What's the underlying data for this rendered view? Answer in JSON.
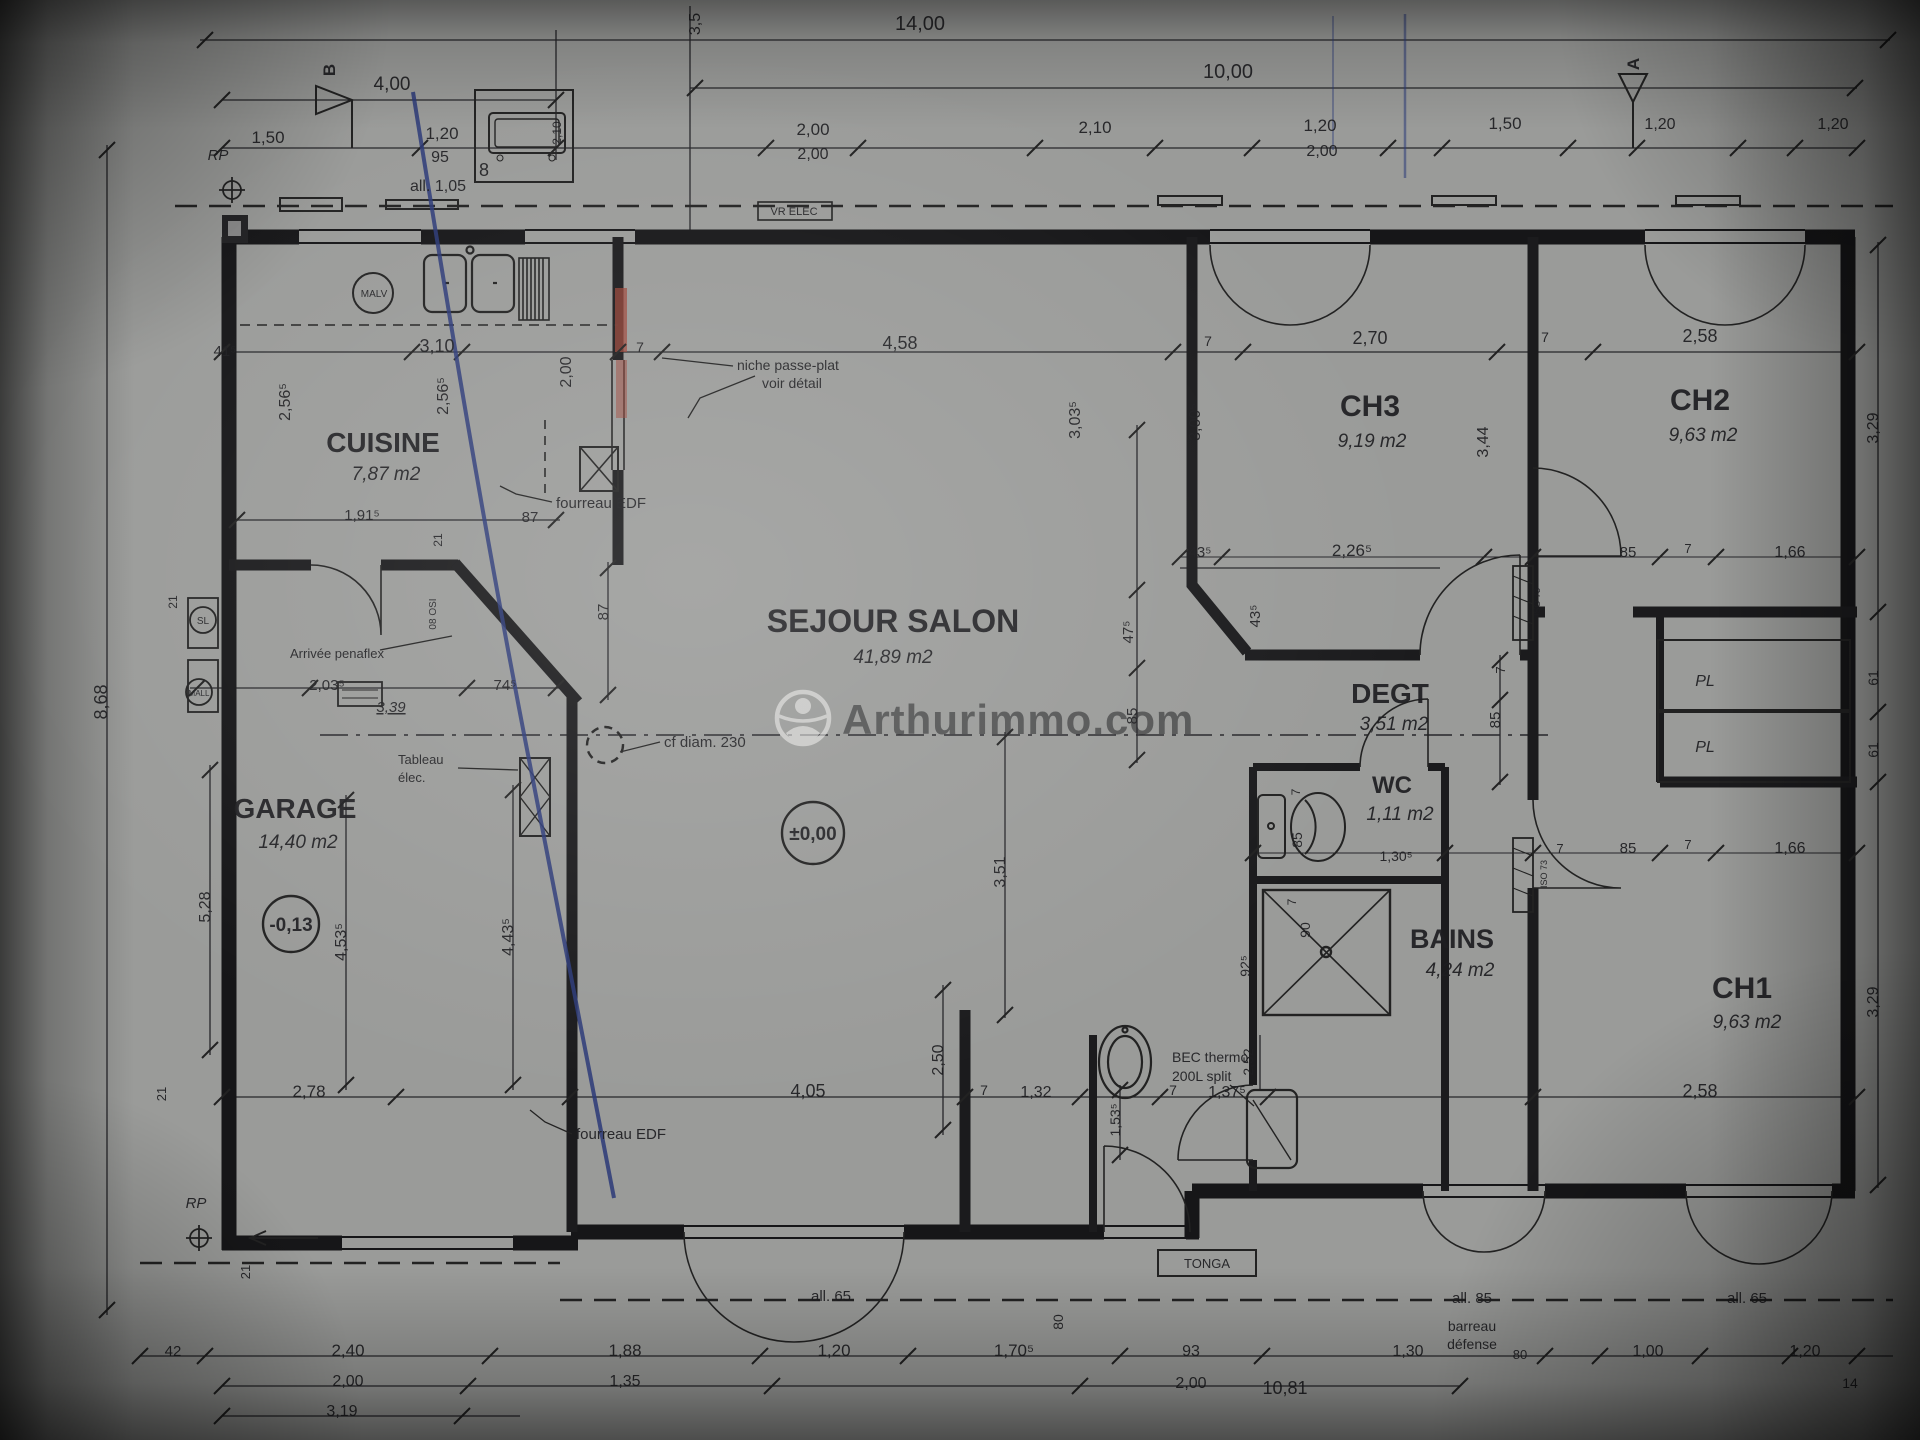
{
  "watermark": {
    "text": "Arthurimmo.com"
  },
  "rooms": [
    {
      "name": "CUISINE",
      "area": "7,87 m2",
      "nx": 383,
      "ny": 452,
      "ns": 28,
      "ax": 386,
      "ay": 480
    },
    {
      "name": "GARAGE",
      "area": "14,40 m2",
      "nx": 295,
      "ny": 818,
      "ns": 28,
      "ax": 298,
      "ay": 848
    },
    {
      "name": "SEJOUR SALON",
      "area": "41,89 m2",
      "nx": 893,
      "ny": 632,
      "ns": 32,
      "ax": 893,
      "ay": 663
    },
    {
      "name": "CH3",
      "area": "9,19 m2",
      "nx": 1370,
      "ny": 416,
      "ns": 30,
      "ax": 1372,
      "ay": 447
    },
    {
      "name": "CH2",
      "area": "9,63 m2",
      "nx": 1700,
      "ny": 410,
      "ns": 30,
      "ax": 1703,
      "ay": 441
    },
    {
      "name": "DEGT",
      "area": "3,51 m2",
      "nx": 1390,
      "ny": 703,
      "ns": 28,
      "ax": 1394,
      "ay": 730
    },
    {
      "name": "WC",
      "area": "1,11 m2",
      "nx": 1392,
      "ny": 793,
      "ns": 24,
      "ax": 1400,
      "ay": 820
    },
    {
      "name": "BAINS",
      "area": "4,24 m2",
      "nx": 1452,
      "ny": 948,
      "ns": 27,
      "ax": 1460,
      "ay": 976
    },
    {
      "name": "CH1",
      "area": "9,63 m2",
      "nx": 1742,
      "ny": 998,
      "ns": 30,
      "ax": 1747,
      "ay": 1028
    }
  ],
  "levels": [
    {
      "t": "±0,00",
      "x": 813,
      "y": 840
    },
    {
      "t": "-0,13",
      "x": 291,
      "y": 931
    }
  ],
  "labels": [
    {
      "t": "14,00",
      "x": 920,
      "y": 30,
      "s": 20
    },
    {
      "t": "3,5",
      "x": 700,
      "y": 24,
      "s": 16,
      "r": -90
    },
    {
      "t": "10,00",
      "x": 1228,
      "y": 78,
      "s": 20
    },
    {
      "t": "4,00",
      "x": 392,
      "y": 90,
      "s": 19
    },
    {
      "t": "B",
      "x": 335,
      "y": 70,
      "s": 17,
      "w": 700,
      "r": -90
    },
    {
      "t": "A",
      "x": 1639,
      "y": 64,
      "s": 17,
      "w": 700,
      "r": -90
    },
    {
      "t": "1,50",
      "x": 268,
      "y": 143,
      "s": 17
    },
    {
      "t": "1,20",
      "x": 442,
      "y": 139,
      "s": 17
    },
    {
      "t": "95",
      "x": 440,
      "y": 162,
      "s": 16
    },
    {
      "t": "all. 1,05",
      "x": 438,
      "y": 191,
      "s": 16
    },
    {
      "t": "RP",
      "x": 218,
      "y": 160,
      "s": 15,
      "i": 1
    },
    {
      "t": "2,00",
      "x": 813,
      "y": 135,
      "s": 17
    },
    {
      "t": "2,00",
      "x": 813,
      "y": 159,
      "s": 16
    },
    {
      "t": "2,10",
      "x": 1095,
      "y": 133,
      "s": 17
    },
    {
      "t": "1,20",
      "x": 1320,
      "y": 131,
      "s": 17
    },
    {
      "t": "2,00",
      "x": 1322,
      "y": 156,
      "s": 16
    },
    {
      "t": "1,50",
      "x": 1505,
      "y": 129,
      "s": 17
    },
    {
      "t": "1,20",
      "x": 1660,
      "y": 129,
      "s": 16
    },
    {
      "t": "1,20",
      "x": 1833,
      "y": 129,
      "s": 16
    },
    {
      "t": "VR ELEC",
      "x": 794,
      "y": 215,
      "s": 11
    },
    {
      "t": "8",
      "x": 484,
      "y": 176,
      "s": 18
    },
    {
      "t": "2,10",
      "x": 561,
      "y": 133,
      "s": 12,
      "r": -90
    },
    {
      "t": "41⁵",
      "x": 225,
      "y": 356,
      "s": 15
    },
    {
      "t": "3,10",
      "x": 437,
      "y": 352,
      "s": 18
    },
    {
      "t": "2,00",
      "x": 571,
      "y": 372,
      "s": 16,
      "r": -90
    },
    {
      "t": "7",
      "x": 640,
      "y": 352,
      "s": 14
    },
    {
      "t": "4,58",
      "x": 900,
      "y": 349,
      "s": 18
    },
    {
      "t": "7",
      "x": 1208,
      "y": 346,
      "s": 14
    },
    {
      "t": "2,70",
      "x": 1370,
      "y": 344,
      "s": 18
    },
    {
      "t": "7",
      "x": 1545,
      "y": 342,
      "s": 14
    },
    {
      "t": "2,58",
      "x": 1700,
      "y": 342,
      "s": 18
    },
    {
      "t": "2,56⁵",
      "x": 290,
      "y": 402,
      "s": 16,
      "r": -90
    },
    {
      "t": "2,56⁵",
      "x": 448,
      "y": 396,
      "s": 16,
      "r": -90
    },
    {
      "t": "3,03⁵",
      "x": 1080,
      "y": 420,
      "s": 16,
      "r": -90
    },
    {
      "t": "3,00⁵",
      "x": 1200,
      "y": 422,
      "s": 16,
      "r": -90
    },
    {
      "t": "3,44",
      "x": 1488,
      "y": 442,
      "s": 16,
      "r": -90
    },
    {
      "t": "3,29",
      "x": 1878,
      "y": 428,
      "s": 16,
      "r": -90
    },
    {
      "t": "MALV",
      "x": 374,
      "y": 297,
      "s": 10
    },
    {
      "t": "niche passe-plat",
      "x": 737,
      "y": 370,
      "s": 14,
      "a": "start"
    },
    {
      "t": "voir détail",
      "x": 762,
      "y": 388,
      "s": 14,
      "a": "start"
    },
    {
      "t": "fourreau EDF",
      "x": 556,
      "y": 508,
      "s": 15,
      "a": "start"
    },
    {
      "t": "1,91⁵",
      "x": 362,
      "y": 520,
      "s": 15
    },
    {
      "t": "87",
      "x": 530,
      "y": 522,
      "s": 15
    },
    {
      "t": "21",
      "x": 442,
      "y": 540,
      "s": 12,
      "r": -90
    },
    {
      "t": "SL",
      "x": 203,
      "y": 624,
      "s": 10
    },
    {
      "t": "MALL",
      "x": 199,
      "y": 696,
      "s": 8
    },
    {
      "t": "21",
      "x": 177,
      "y": 602,
      "s": 12,
      "r": -90
    },
    {
      "t": "08 OSI",
      "x": 436,
      "y": 614,
      "s": 10,
      "r": -90
    },
    {
      "t": "74⁵",
      "x": 505,
      "y": 690,
      "s": 15
    },
    {
      "t": "2,03⁵",
      "x": 327,
      "y": 690,
      "s": 15
    },
    {
      "t": "3,39",
      "x": 391,
      "y": 712,
      "s": 15,
      "i": 1,
      "u": 1
    },
    {
      "t": "Arrivée penaflex",
      "x": 290,
      "y": 658,
      "s": 13,
      "a": "start"
    },
    {
      "t": "87",
      "x": 608,
      "y": 612,
      "s": 15,
      "r": -90
    },
    {
      "t": "Tableau",
      "x": 398,
      "y": 764,
      "s": 13,
      "a": "start"
    },
    {
      "t": "élec.",
      "x": 398,
      "y": 782,
      "s": 13,
      "a": "start"
    },
    {
      "t": "cf diam. 230",
      "x": 664,
      "y": 747,
      "s": 15,
      "a": "start"
    },
    {
      "t": "47⁵",
      "x": 1133,
      "y": 632,
      "s": 15,
      "r": -90
    },
    {
      "t": "85",
      "x": 1137,
      "y": 716,
      "s": 15,
      "r": -90
    },
    {
      "t": "43⁵",
      "x": 1200,
      "y": 557,
      "s": 15
    },
    {
      "t": "2,26⁵",
      "x": 1352,
      "y": 556,
      "s": 17
    },
    {
      "t": "43⁵",
      "x": 1260,
      "y": 616,
      "s": 15,
      "r": -90
    },
    {
      "t": "85",
      "x": 1500,
      "y": 720,
      "s": 15,
      "r": -90
    },
    {
      "t": "7",
      "x": 1505,
      "y": 670,
      "s": 13,
      "r": -90
    },
    {
      "t": "85",
      "x": 1628,
      "y": 557,
      "s": 15
    },
    {
      "t": "7",
      "x": 1688,
      "y": 553,
      "s": 13
    },
    {
      "t": "1,66",
      "x": 1790,
      "y": 557,
      "s": 16
    },
    {
      "t": "ISO 73",
      "x": 1540,
      "y": 602,
      "s": 9,
      "r": -90
    },
    {
      "t": "ISO 73",
      "x": 1547,
      "y": 874,
      "s": 9,
      "r": -90
    },
    {
      "t": "PL",
      "x": 1705,
      "y": 686,
      "s": 16,
      "i": 1
    },
    {
      "t": "PL",
      "x": 1705,
      "y": 752,
      "s": 16,
      "i": 1
    },
    {
      "t": "61",
      "x": 1878,
      "y": 678,
      "s": 14,
      "r": -90
    },
    {
      "t": "61",
      "x": 1878,
      "y": 750,
      "s": 14,
      "r": -90
    },
    {
      "t": "7",
      "x": 1560,
      "y": 853,
      "s": 13
    },
    {
      "t": "85",
      "x": 1628,
      "y": 853,
      "s": 15
    },
    {
      "t": "7",
      "x": 1688,
      "y": 849,
      "s": 13
    },
    {
      "t": "1,66",
      "x": 1790,
      "y": 853,
      "s": 16
    },
    {
      "t": "1,30⁵",
      "x": 1396,
      "y": 861,
      "s": 14
    },
    {
      "t": "7",
      "x": 1300,
      "y": 792,
      "s": 12,
      "r": -90
    },
    {
      "t": "85",
      "x": 1302,
      "y": 840,
      "s": 14,
      "r": -90
    },
    {
      "t": "7",
      "x": 1296,
      "y": 902,
      "s": 12,
      "r": -90
    },
    {
      "t": "90",
      "x": 1310,
      "y": 930,
      "s": 14,
      "r": -90
    },
    {
      "t": "92⁵",
      "x": 1250,
      "y": 966,
      "s": 14,
      "r": -90
    },
    {
      "t": "8,68",
      "x": 107,
      "y": 702,
      "s": 18,
      "r": -90
    },
    {
      "t": "5,28",
      "x": 210,
      "y": 907,
      "s": 16,
      "r": -90
    },
    {
      "t": "4,53⁵",
      "x": 346,
      "y": 942,
      "s": 16,
      "r": -90
    },
    {
      "t": "4,43⁵",
      "x": 513,
      "y": 937,
      "s": 16,
      "r": -90
    },
    {
      "t": "3,51",
      "x": 1005,
      "y": 872,
      "s": 16,
      "r": -90
    },
    {
      "t": "2,50",
      "x": 943,
      "y": 1060,
      "s": 16,
      "r": -90
    },
    {
      "t": "fourreau EDF",
      "x": 576,
      "y": 1139,
      "s": 15,
      "a": "start"
    },
    {
      "t": "21",
      "x": 166,
      "y": 1094,
      "s": 13,
      "r": -90
    },
    {
      "t": "2,78",
      "x": 309,
      "y": 1097,
      "s": 17
    },
    {
      "t": "4,05",
      "x": 808,
      "y": 1097,
      "s": 18
    },
    {
      "t": "7",
      "x": 984,
      "y": 1095,
      "s": 14
    },
    {
      "t": "1,32",
      "x": 1036,
      "y": 1097,
      "s": 16
    },
    {
      "t": "1,53⁵",
      "x": 1120,
      "y": 1120,
      "s": 14,
      "r": -90
    },
    {
      "t": "7",
      "x": 1173,
      "y": 1095,
      "s": 14
    },
    {
      "t": "1,37⁵",
      "x": 1227,
      "y": 1097,
      "s": 16
    },
    {
      "t": "2,52",
      "x": 1253,
      "y": 1062,
      "s": 14,
      "r": -90
    },
    {
      "t": "BEC thermo",
      "x": 1172,
      "y": 1062,
      "s": 14,
      "a": "start"
    },
    {
      "t": "200L split",
      "x": 1172,
      "y": 1081,
      "s": 14,
      "a": "start"
    },
    {
      "t": "2,58",
      "x": 1700,
      "y": 1097,
      "s": 18
    },
    {
      "t": "3,29",
      "x": 1878,
      "y": 1002,
      "s": 16,
      "r": -90
    },
    {
      "t": "RP",
      "x": 196,
      "y": 1208,
      "s": 15,
      "i": 1
    },
    {
      "t": "21",
      "x": 250,
      "y": 1272,
      "s": 13,
      "r": -90
    },
    {
      "t": "TONGA",
      "x": 1207,
      "y": 1268,
      "s": 13
    },
    {
      "t": "all. 65",
      "x": 831,
      "y": 1301,
      "s": 15
    },
    {
      "t": "80",
      "x": 1063,
      "y": 1322,
      "s": 14,
      "r": -90
    },
    {
      "t": "all. 85",
      "x": 1472,
      "y": 1303,
      "s": 15
    },
    {
      "t": "barreau",
      "x": 1472,
      "y": 1331,
      "s": 14
    },
    {
      "t": "défense",
      "x": 1472,
      "y": 1349,
      "s": 14
    },
    {
      "t": "all. 65",
      "x": 1747,
      "y": 1303,
      "s": 15
    },
    {
      "t": "42",
      "x": 173,
      "y": 1356,
      "s": 15
    },
    {
      "t": "2,40",
      "x": 348,
      "y": 1356,
      "s": 17
    },
    {
      "t": "1,88",
      "x": 625,
      "y": 1356,
      "s": 17
    },
    {
      "t": "1,20",
      "x": 834,
      "y": 1356,
      "s": 17
    },
    {
      "t": "1,70⁵",
      "x": 1014,
      "y": 1356,
      "s": 17
    },
    {
      "t": "93",
      "x": 1191,
      "y": 1356,
      "s": 16
    },
    {
      "t": "1,30",
      "x": 1408,
      "y": 1356,
      "s": 16
    },
    {
      "t": "80",
      "x": 1520,
      "y": 1359,
      "s": 13
    },
    {
      "t": "1,00",
      "x": 1648,
      "y": 1356,
      "s": 16
    },
    {
      "t": "1,20",
      "x": 1805,
      "y": 1356,
      "s": 16
    },
    {
      "t": "2,00",
      "x": 348,
      "y": 1386,
      "s": 16
    },
    {
      "t": "1,35",
      "x": 625,
      "y": 1386,
      "s": 16
    },
    {
      "t": "2,00",
      "x": 1191,
      "y": 1388,
      "s": 16
    },
    {
      "t": "10,81",
      "x": 1285,
      "y": 1394,
      "s": 18
    },
    {
      "t": "3,19",
      "x": 342,
      "y": 1416,
      "s": 16
    },
    {
      "t": "14",
      "x": 1850,
      "y": 1388,
      "s": 14
    }
  ]
}
